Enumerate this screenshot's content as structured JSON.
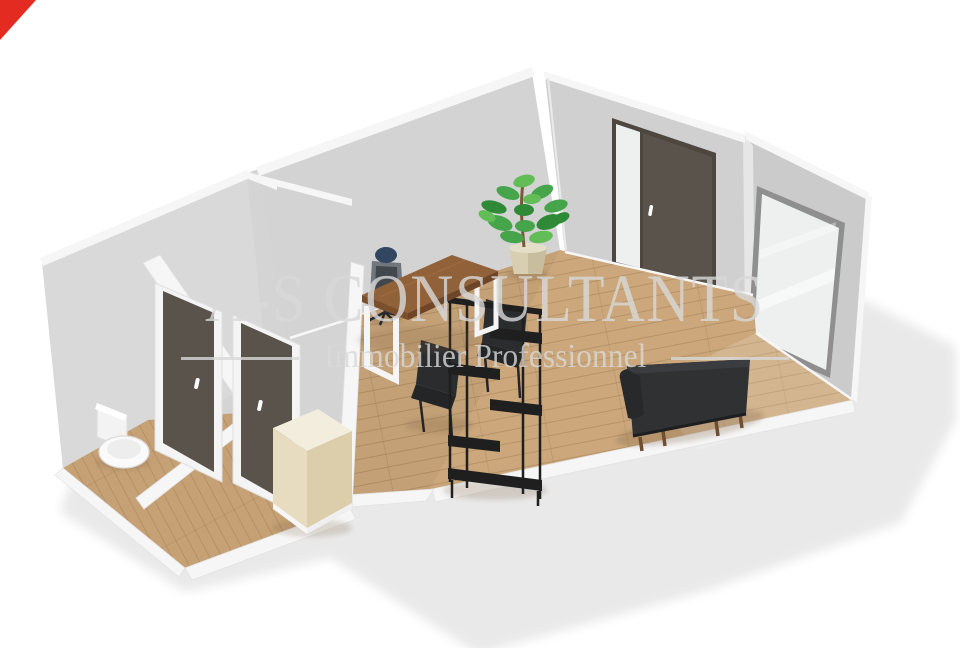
{
  "watermark": {
    "title": "A-S CONSULTANTS",
    "subtitle": "Immobilier Professionnel",
    "color": "#d9d9d9",
    "opacity": "0.8"
  },
  "ribbon": {
    "color": "#e32b22"
  },
  "scene": {
    "type": "3d-floor-plan-render",
    "description": "isometric cutaway floor plan of an office with entry corridor, WC and main room",
    "colors": {
      "pageBg": "#ffffff",
      "groundShadow": "#e9e9e9",
      "massGray": "#d4d4d4",
      "wallA": "#d9d9d9",
      "wallC": "#d3d3d3",
      "wallR1": "#d0d0d0",
      "wallR2": "#cbcbcb",
      "wallJog": "#e6e6e6",
      "cutWall": "#f6f6f6",
      "baseboard": "#f7f7f7",
      "floorWood": "#cba77b",
      "floorCorridor": "#c6a175",
      "plankLine": "#8f6c44",
      "doorDark": "#5a534c",
      "doorFrameDark": "#4d473f",
      "doorFrameWhite": "#f4f4f4",
      "glass": "#eef0f0",
      "glassFrame": "#8f8f8f",
      "toiletWhite": "#fafafa",
      "cabinetTop": "#f2eddd",
      "cabinetFront": "#e7dcc0",
      "cabinetSide": "#dccdab",
      "shelfBlack": "#1f1f1f",
      "deskTop": "#91613a",
      "deskEdge": "#6e4527",
      "deskLegs": "#f5f5f5",
      "chairBlack": "#2a2c2e",
      "chairSeat": "#232527",
      "officeChairGray": "#70767d",
      "officeChairInner": "#42474d",
      "officeChairNavy": "#32465f",
      "sofaBody": "#2f3133",
      "sofaTopEdge": "#3a3c3f",
      "sofaArm": "#28292b",
      "sofaLegs": "#6f4e31",
      "plantGreen": "#46a44a",
      "plantGreenDark": "#2f8a38",
      "plantGreenLight": "#63bd57",
      "plantTrunk": "#7b5836",
      "plantPot": "#d8cfb2",
      "plantPotShade": "#c2b795",
      "objShadow": "#7a6142"
    },
    "objects": [
      {
        "name": "toilet"
      },
      {
        "name": "interior-door-1"
      },
      {
        "name": "interior-door-2"
      },
      {
        "name": "entrance-door"
      },
      {
        "name": "window"
      },
      {
        "name": "potted-plant"
      },
      {
        "name": "desk"
      },
      {
        "name": "office-chair"
      },
      {
        "name": "visitor-chair-1"
      },
      {
        "name": "visitor-chair-2"
      },
      {
        "name": "shelving-unit"
      },
      {
        "name": "cabinet"
      },
      {
        "name": "sofa"
      }
    ]
  }
}
